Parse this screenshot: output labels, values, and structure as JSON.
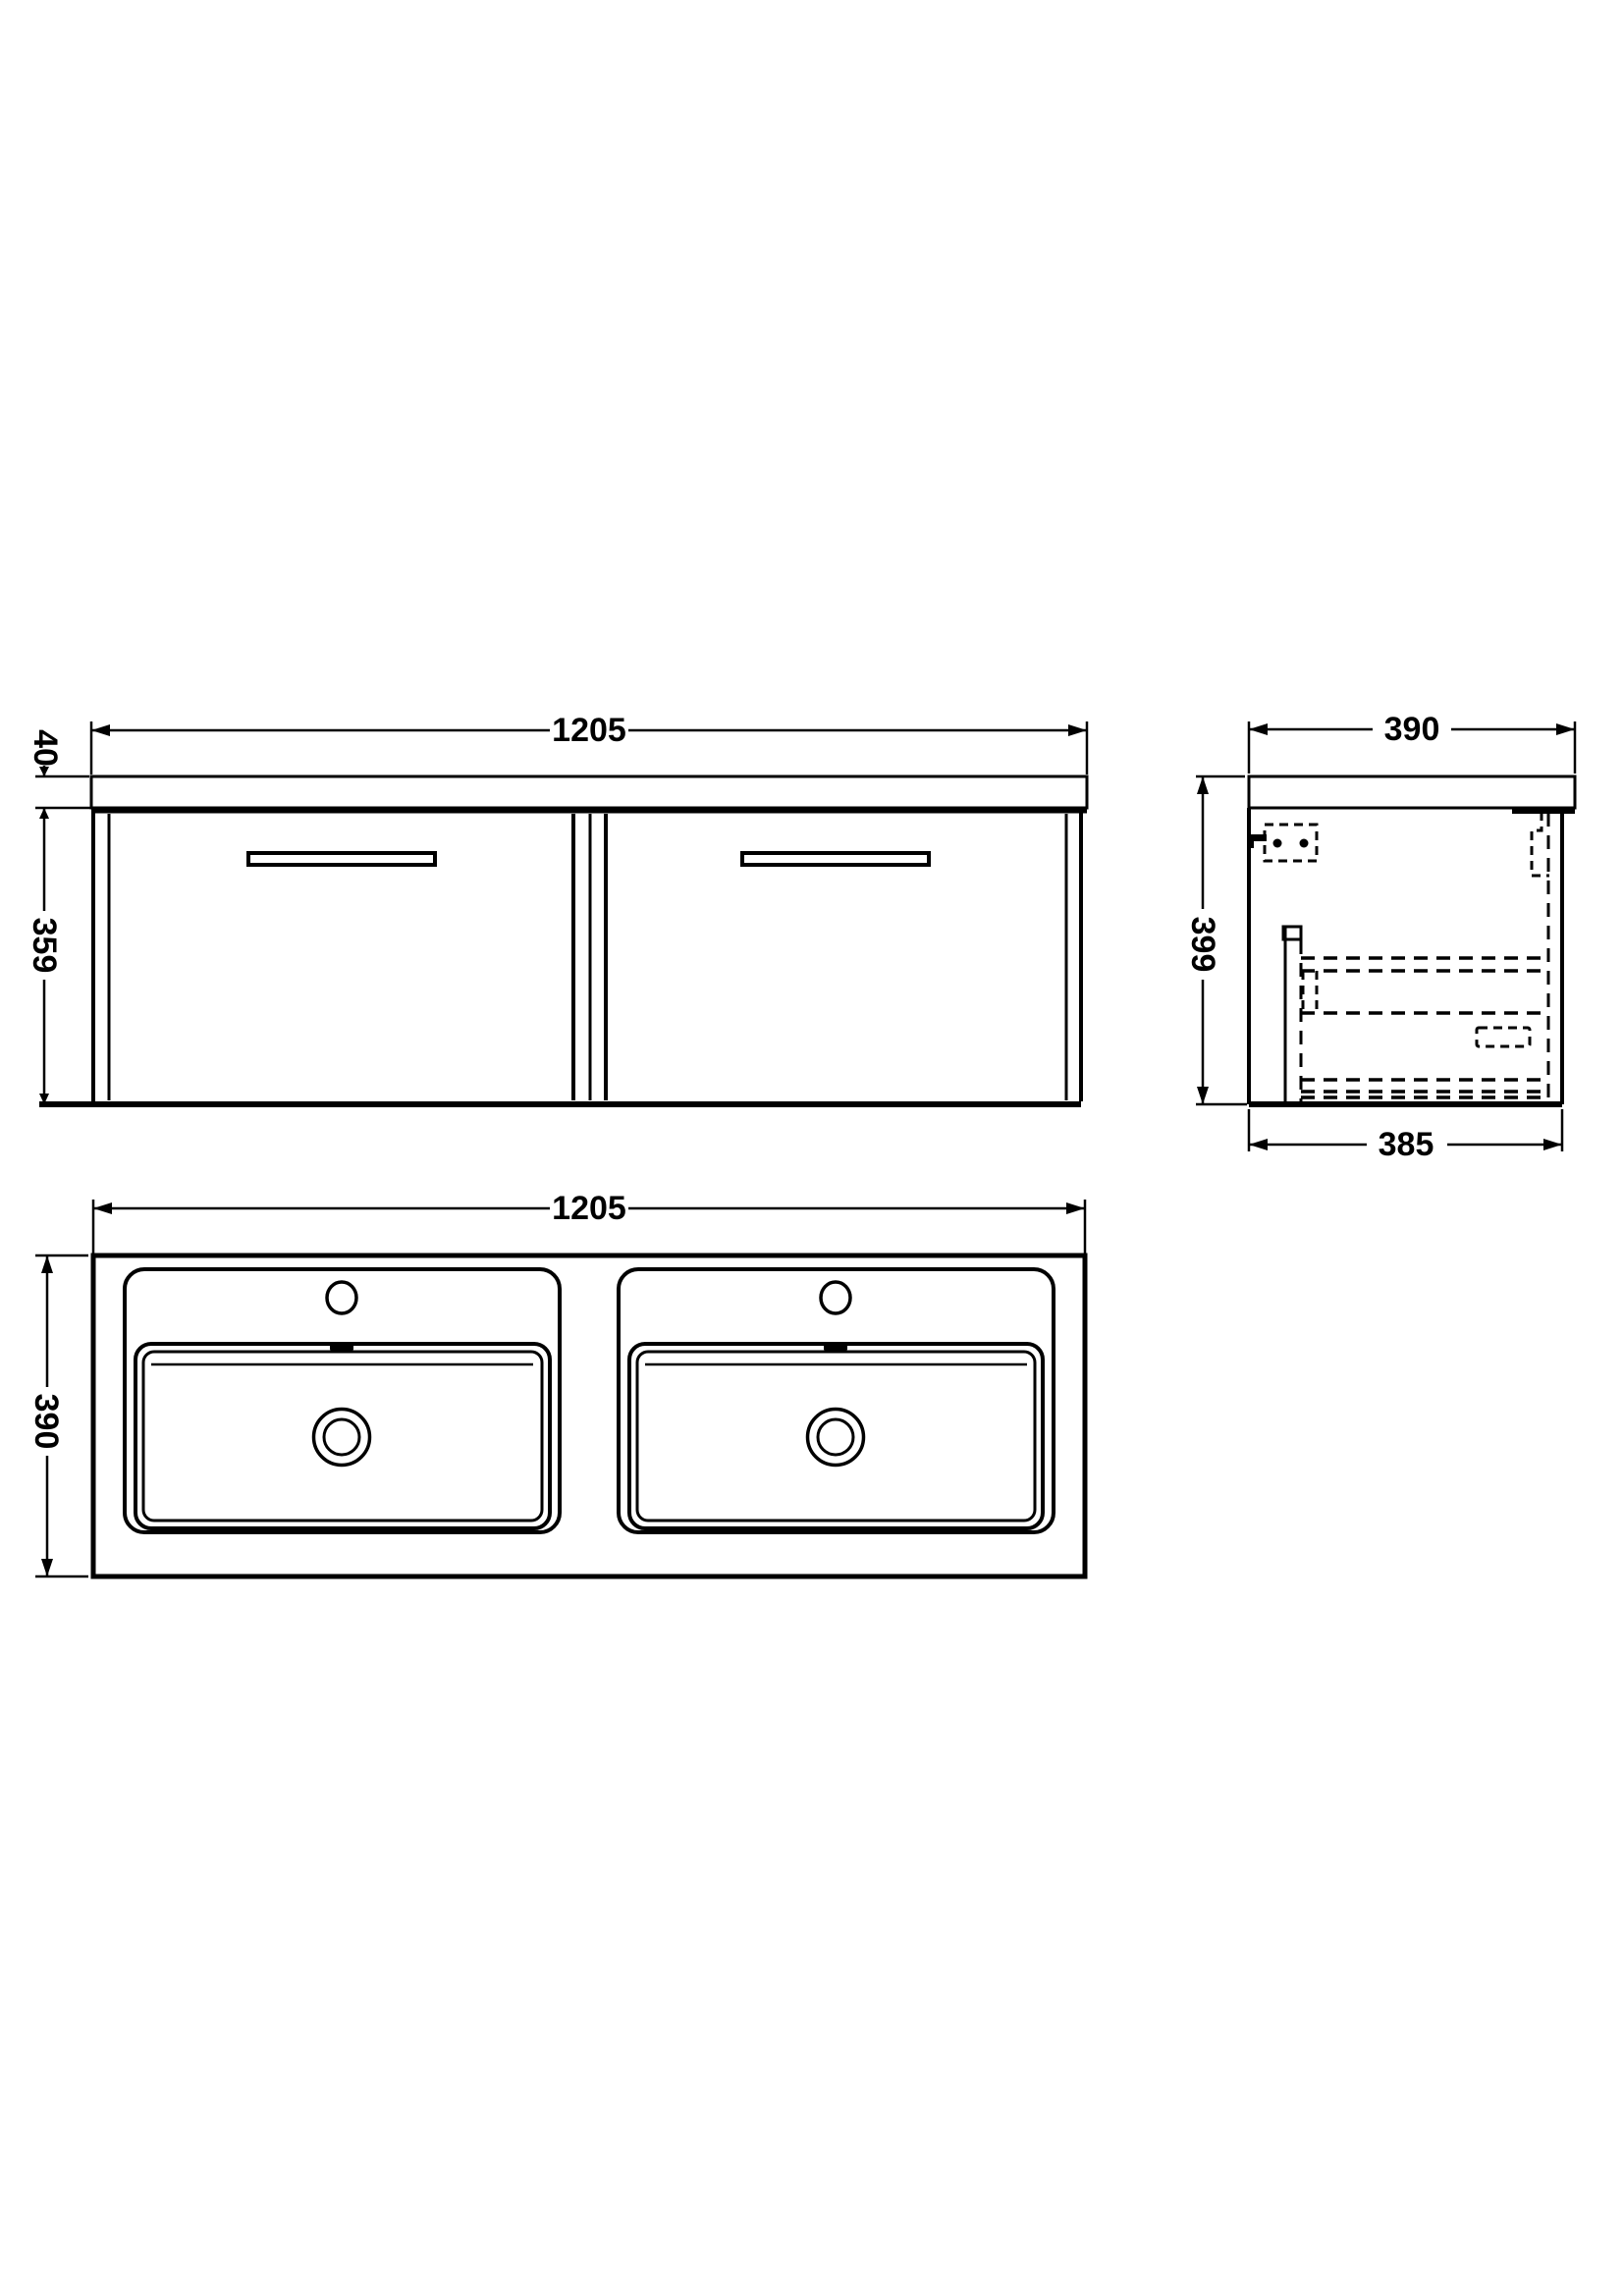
{
  "drawing": {
    "type": "technical-dimension-diagram",
    "subject": "wall-hung double-basin vanity unit, three orthographic views",
    "line_color": "#000000",
    "background_color": "#ffffff"
  },
  "views": {
    "front": {
      "title": "front elevation",
      "dims": {
        "width": "1205",
        "counter_thickness": "40",
        "cabinet_height": "359"
      }
    },
    "side": {
      "title": "side elevation",
      "dims": {
        "depth": "390",
        "height": "399",
        "cabinet_depth": "385"
      }
    },
    "plan": {
      "title": "plan view of double basin",
      "dims": {
        "width": "1205",
        "depth": "390"
      }
    }
  }
}
